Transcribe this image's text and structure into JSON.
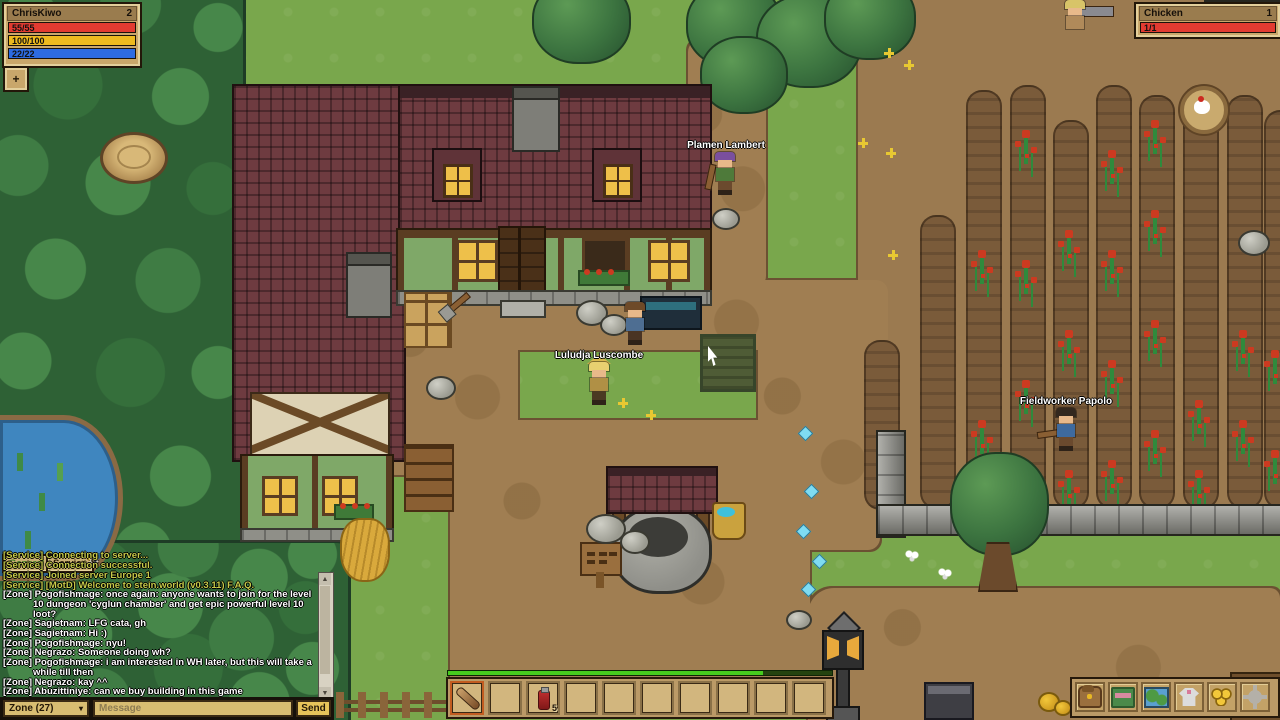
{
  "hud": {
    "player": {
      "name": "ChrisKiwo",
      "level": "2",
      "hp": "55/55",
      "stamina": "100/100",
      "mana": "22/22",
      "plus": "+"
    },
    "target": {
      "name": "Chicken",
      "level": "1",
      "hp": "1/1"
    }
  },
  "chat": {
    "tabs": {
      "general": "General",
      "service": "Service"
    },
    "messages": [
      {
        "channel": "Service",
        "text": "[Service] Connecting to server..."
      },
      {
        "channel": "Service",
        "text": "[Service] Connection successful."
      },
      {
        "channel": "Service",
        "text": "[Service] Joined server Europe 1"
      },
      {
        "channel": "Service",
        "text": "[Service] [MotD] Welcome to stein.world (v0.3.11) F.A.Q."
      },
      {
        "channel": "Zone",
        "text": "[Zone] Pogofishmage: once again: anyone wants to join for the level 10 dungeon 'cyglun chamber' and get epic powerful level 10 loot?"
      },
      {
        "channel": "Zone",
        "text": "[Zone] Sagietnam: LFG cata, gh"
      },
      {
        "channel": "Zone",
        "text": "[Zone] Sagietnam: Hi :)"
      },
      {
        "channel": "Zone",
        "text": "[Zone] Pogofishmage: nyu!"
      },
      {
        "channel": "Zone",
        "text": "[Zone] Negrazo: Someone doing wh?"
      },
      {
        "channel": "Zone",
        "text": "[Zone] Pogofishmage: i am interested in WH later, but this will take a while till then"
      },
      {
        "channel": "Zone",
        "text": "[Zone] Negrazo: kay ^^"
      },
      {
        "channel": "Zone",
        "text": "[Zone] Abuzittiniye: can we buy building in this game"
      }
    ],
    "channel_select": "Zone (27)",
    "input_placeholder": "Message",
    "send": "Send"
  },
  "hotbar": {
    "potion_count": "5",
    "xp_percent": "82"
  },
  "world": {
    "npcs": {
      "plamen": "Plamen Lambert",
      "luludja": "Luludja Luscombe",
      "papolo": "Fieldworker Papolo"
    }
  },
  "colors": {
    "hp_bar": "#e23b31",
    "stamina_bar": "#edba1f",
    "mana_bar": "#2d6be2",
    "xp_bar": "#46cc1e",
    "service_text": "#c6ca49",
    "zone_text": "#ffffff",
    "ui_panel": "#c9a76b"
  }
}
